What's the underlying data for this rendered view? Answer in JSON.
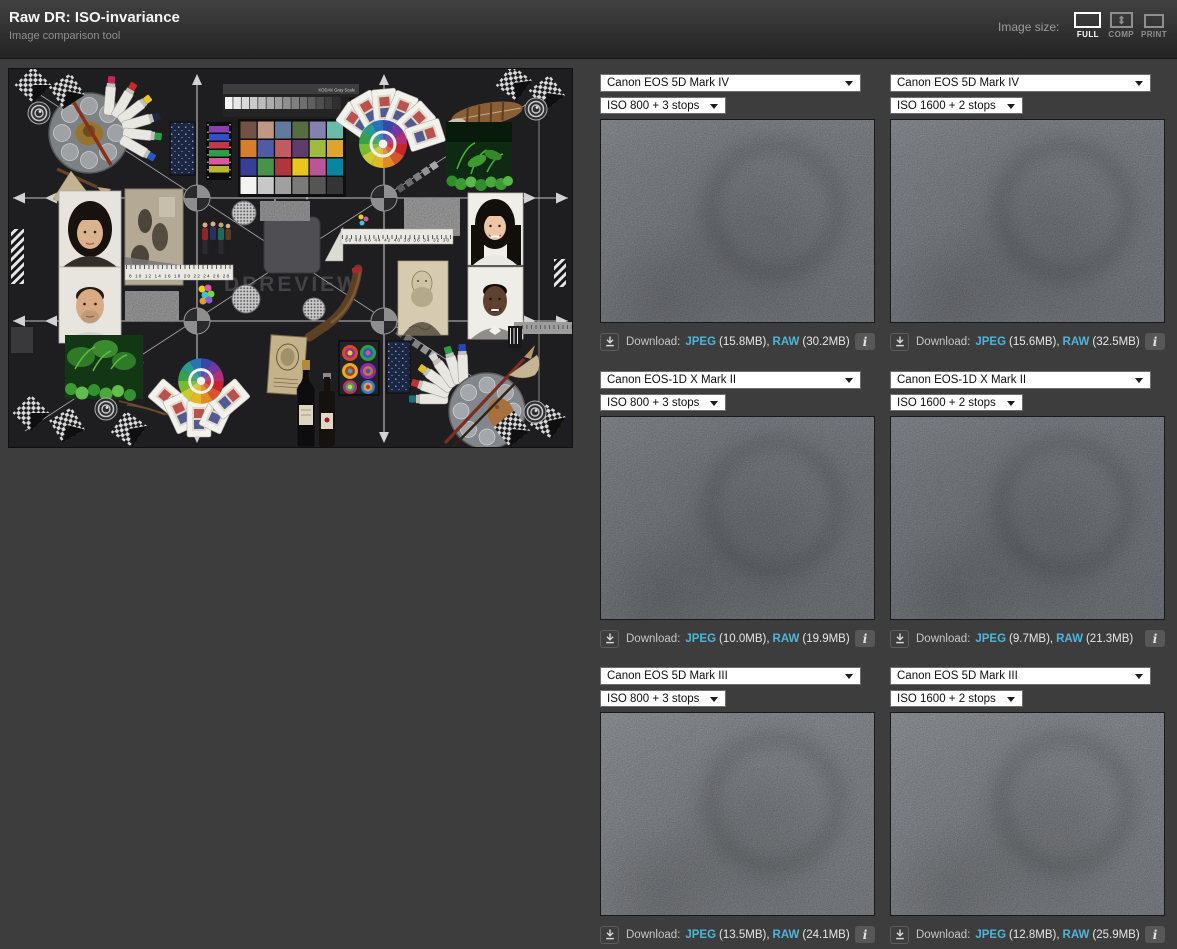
{
  "header": {
    "title": "Raw DR: ISO-invariance",
    "subtitle": "Image comparison tool",
    "image_size_label": "Image size:",
    "sizes": {
      "full": "FULL",
      "comp": "COMP",
      "print": "PRINT"
    }
  },
  "labels": {
    "download": "Download:",
    "jpeg": "JPEG",
    "raw": "RAW",
    "info": "i"
  },
  "scene": {
    "watermark": "DPREVIEW",
    "kodak": "KODAK Gray Scale",
    "ruler_a": "8 10 12 14 16 18 20 22 24 26 28",
    "ruler_b": "50 48 46 44 42 40 38 36 34 32 30"
  },
  "panels": [
    {
      "camera": "Canon EOS 5D Mark IV",
      "iso": "ISO 800 + 3 stops",
      "jpeg_size": "(15.8MB),",
      "raw_size": "(30.2MB)"
    },
    {
      "camera": "Canon EOS 5D Mark IV",
      "iso": "ISO 1600 + 2 stops",
      "jpeg_size": "(15.6MB),",
      "raw_size": "(32.5MB)"
    },
    {
      "camera": "Canon EOS-1D X Mark II",
      "iso": "ISO 800 + 3 stops",
      "jpeg_size": "(10.0MB),",
      "raw_size": "(19.9MB)"
    },
    {
      "camera": "Canon EOS-1D X Mark II",
      "iso": "ISO 1600 + 2 stops",
      "jpeg_size": "(9.7MB),",
      "raw_size": "(21.3MB)"
    },
    {
      "camera": "Canon EOS 5D Mark III",
      "iso": "ISO 800 + 3 stops",
      "jpeg_size": "(13.5MB),",
      "raw_size": "(24.1MB)"
    },
    {
      "camera": "Canon EOS 5D Mark III",
      "iso": "ISO 1600 + 2 stops",
      "jpeg_size": "(12.8MB),",
      "raw_size": "(25.9MB)"
    }
  ],
  "colors": {
    "page_bg": "#3d3d3d",
    "link": "#4db5d9",
    "active": "#ffffff"
  }
}
